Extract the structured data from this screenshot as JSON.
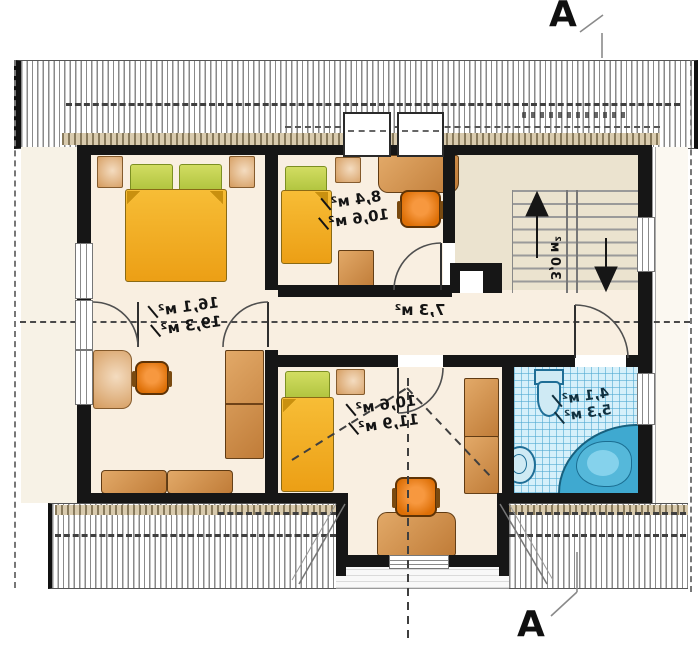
{
  "section": {
    "label": "A"
  },
  "rooms": {
    "main_bedroom": {
      "area_usable": "16,1 м²",
      "area_total": "19,3 м²"
    },
    "top_bedroom": {
      "area_usable": "8,4 м²",
      "area_total": "10,6 м²"
    },
    "hall": {
      "area_usable": "7,3 м²"
    },
    "staircase": {
      "area_usable": "3,0 м²"
    },
    "bottom_bedroom": {
      "area_usable": "10,6 м²",
      "area_total": "11,9 м²"
    },
    "bathroom": {
      "area_usable": "4,1 м²",
      "area_total": "5,3 м²"
    }
  },
  "colors": {
    "wall": "#161616",
    "room_fill": "#f9efe1",
    "hall_fill": "#ebe3cf",
    "tile_fill": "#d6f0fa",
    "wood": "#cf8a4a",
    "bed_orange": "#f2ae28",
    "pillow_green": "#bcd04e",
    "tub_blue": "#3fa9d0",
    "chair_orange": "#e87d1a",
    "tan_strip": "#d9cbae"
  }
}
